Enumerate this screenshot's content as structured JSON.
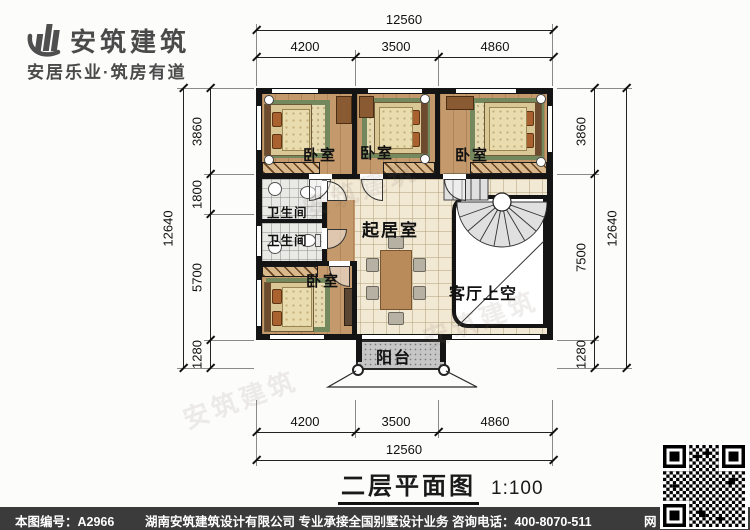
{
  "logo": {
    "name": "安筑建筑",
    "tagline": "安居乐业·筑房有道"
  },
  "drawing": {
    "title": "二层平面图",
    "scale": "1:100"
  },
  "rooms": {
    "bedroom_top_left": "卧室",
    "bedroom_top_mid": "卧室",
    "bedroom_top_right": "卧室",
    "bathroom_upper": "卫生间",
    "bathroom_lower": "卫生间",
    "living": "起居室",
    "bedroom_bottom": "卧室",
    "void_over_living": "客厅上空",
    "balcony": "阳台"
  },
  "dimensions": {
    "top": {
      "overall": "12560",
      "segments": [
        "4200",
        "3500",
        "4860"
      ]
    },
    "bottom": {
      "overall": "12560",
      "segments": [
        "4200",
        "3500",
        "4860"
      ]
    },
    "left": {
      "overall": "12640",
      "segments": [
        "3860",
        "1800",
        "5700",
        "1280"
      ]
    },
    "right": {
      "overall": "12640",
      "segments": [
        "3860",
        "7500",
        "1280"
      ]
    }
  },
  "footer": {
    "drawing_no": "本图编号：A2966",
    "company": "湖南安筑建筑设计有限公司  专业承接全国别墅设计业务  咨询电话：400-8070-511",
    "web_mark": "网"
  },
  "colors": {
    "wall": "#141414",
    "wood_floor": "#c49a6c",
    "tile_floor": "#f2e9d4",
    "bath_floor": "#e9e9e5",
    "balcony_floor": "#c6c6c6",
    "rug": "#74885e",
    "footer_bg": "#3b3b3b",
    "logo_gray": "#4a4a4a"
  }
}
